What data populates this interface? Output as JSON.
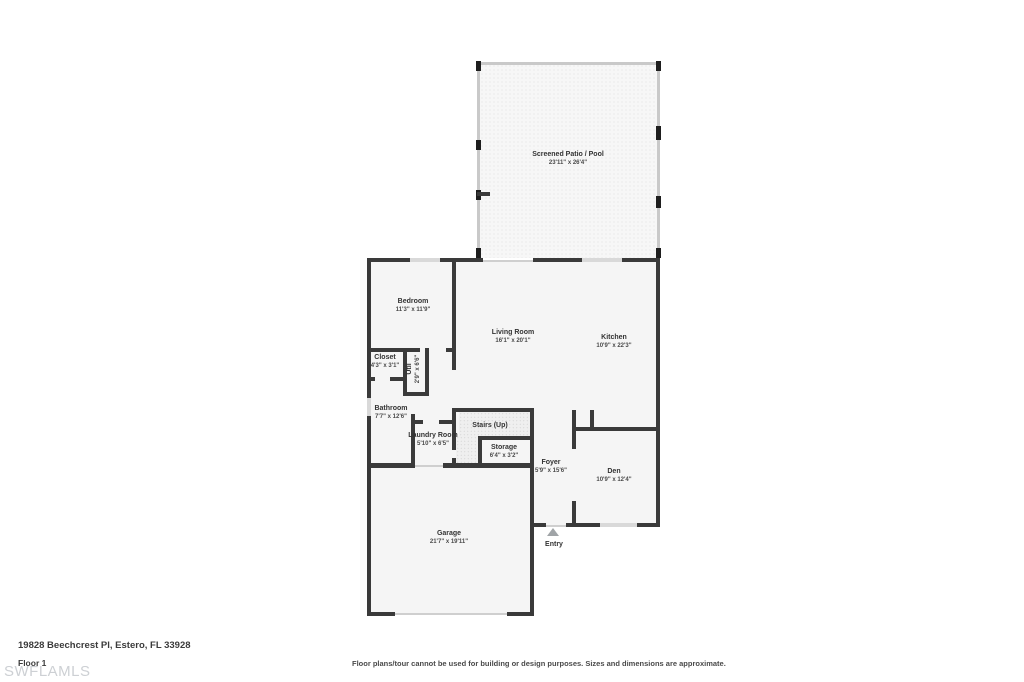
{
  "floorplan": {
    "rooms": {
      "patio": {
        "name": "Screened Patio / Pool",
        "dims": "23'11\" x 26'4\""
      },
      "bedroom": {
        "name": "Bedroom",
        "dims": "11'3\" x 11'9\""
      },
      "living_room": {
        "name": "Living Room",
        "dims": "16'1\" x 20'1\""
      },
      "kitchen": {
        "name": "Kitchen",
        "dims": "10'9\" x 22'3\""
      },
      "closet": {
        "name": "Closet",
        "dims": "4'3\" x 3'1\""
      },
      "util": {
        "name": "Util",
        "dims": "2'9\" x 6'6\""
      },
      "bathroom": {
        "name": "Bathroom",
        "dims": "7'7\" x 12'6\""
      },
      "laundry": {
        "name": "Laundry Room",
        "dims": "5'10\" x 6'5\""
      },
      "stairs": {
        "name": "Stairs (Up)"
      },
      "storage": {
        "name": "Storage",
        "dims": "6'4\" x 3'2\""
      },
      "foyer": {
        "name": "Foyer",
        "dims": "5'9\" x 15'6\""
      },
      "den": {
        "name": "Den",
        "dims": "10'9\" x 12'4\""
      },
      "garage": {
        "name": "Garage",
        "dims": "21'7\" x 19'11\""
      },
      "entry": {
        "name": "Entry"
      }
    }
  },
  "footer": {
    "address": "19828 Beechcrest Pl, Estero, FL 33928",
    "floor_label": "Floor 1",
    "watermark": "SWFLAMLS",
    "disclaimer": "Floor plans/tour cannot be used for building or design purposes. Sizes and dimensions are approximate."
  },
  "colors": {
    "wall": "#3a3a3a",
    "window": "#d9d9d9",
    "door_opening": "#cfcfcf",
    "screen_wall": "#c9c9c9",
    "screen_post": "#1e1e1e",
    "room_fill": "#f5f5f5",
    "label_text": "#333333",
    "dims_text": "#4a4a4a",
    "watermark": "#cdd0d4"
  }
}
